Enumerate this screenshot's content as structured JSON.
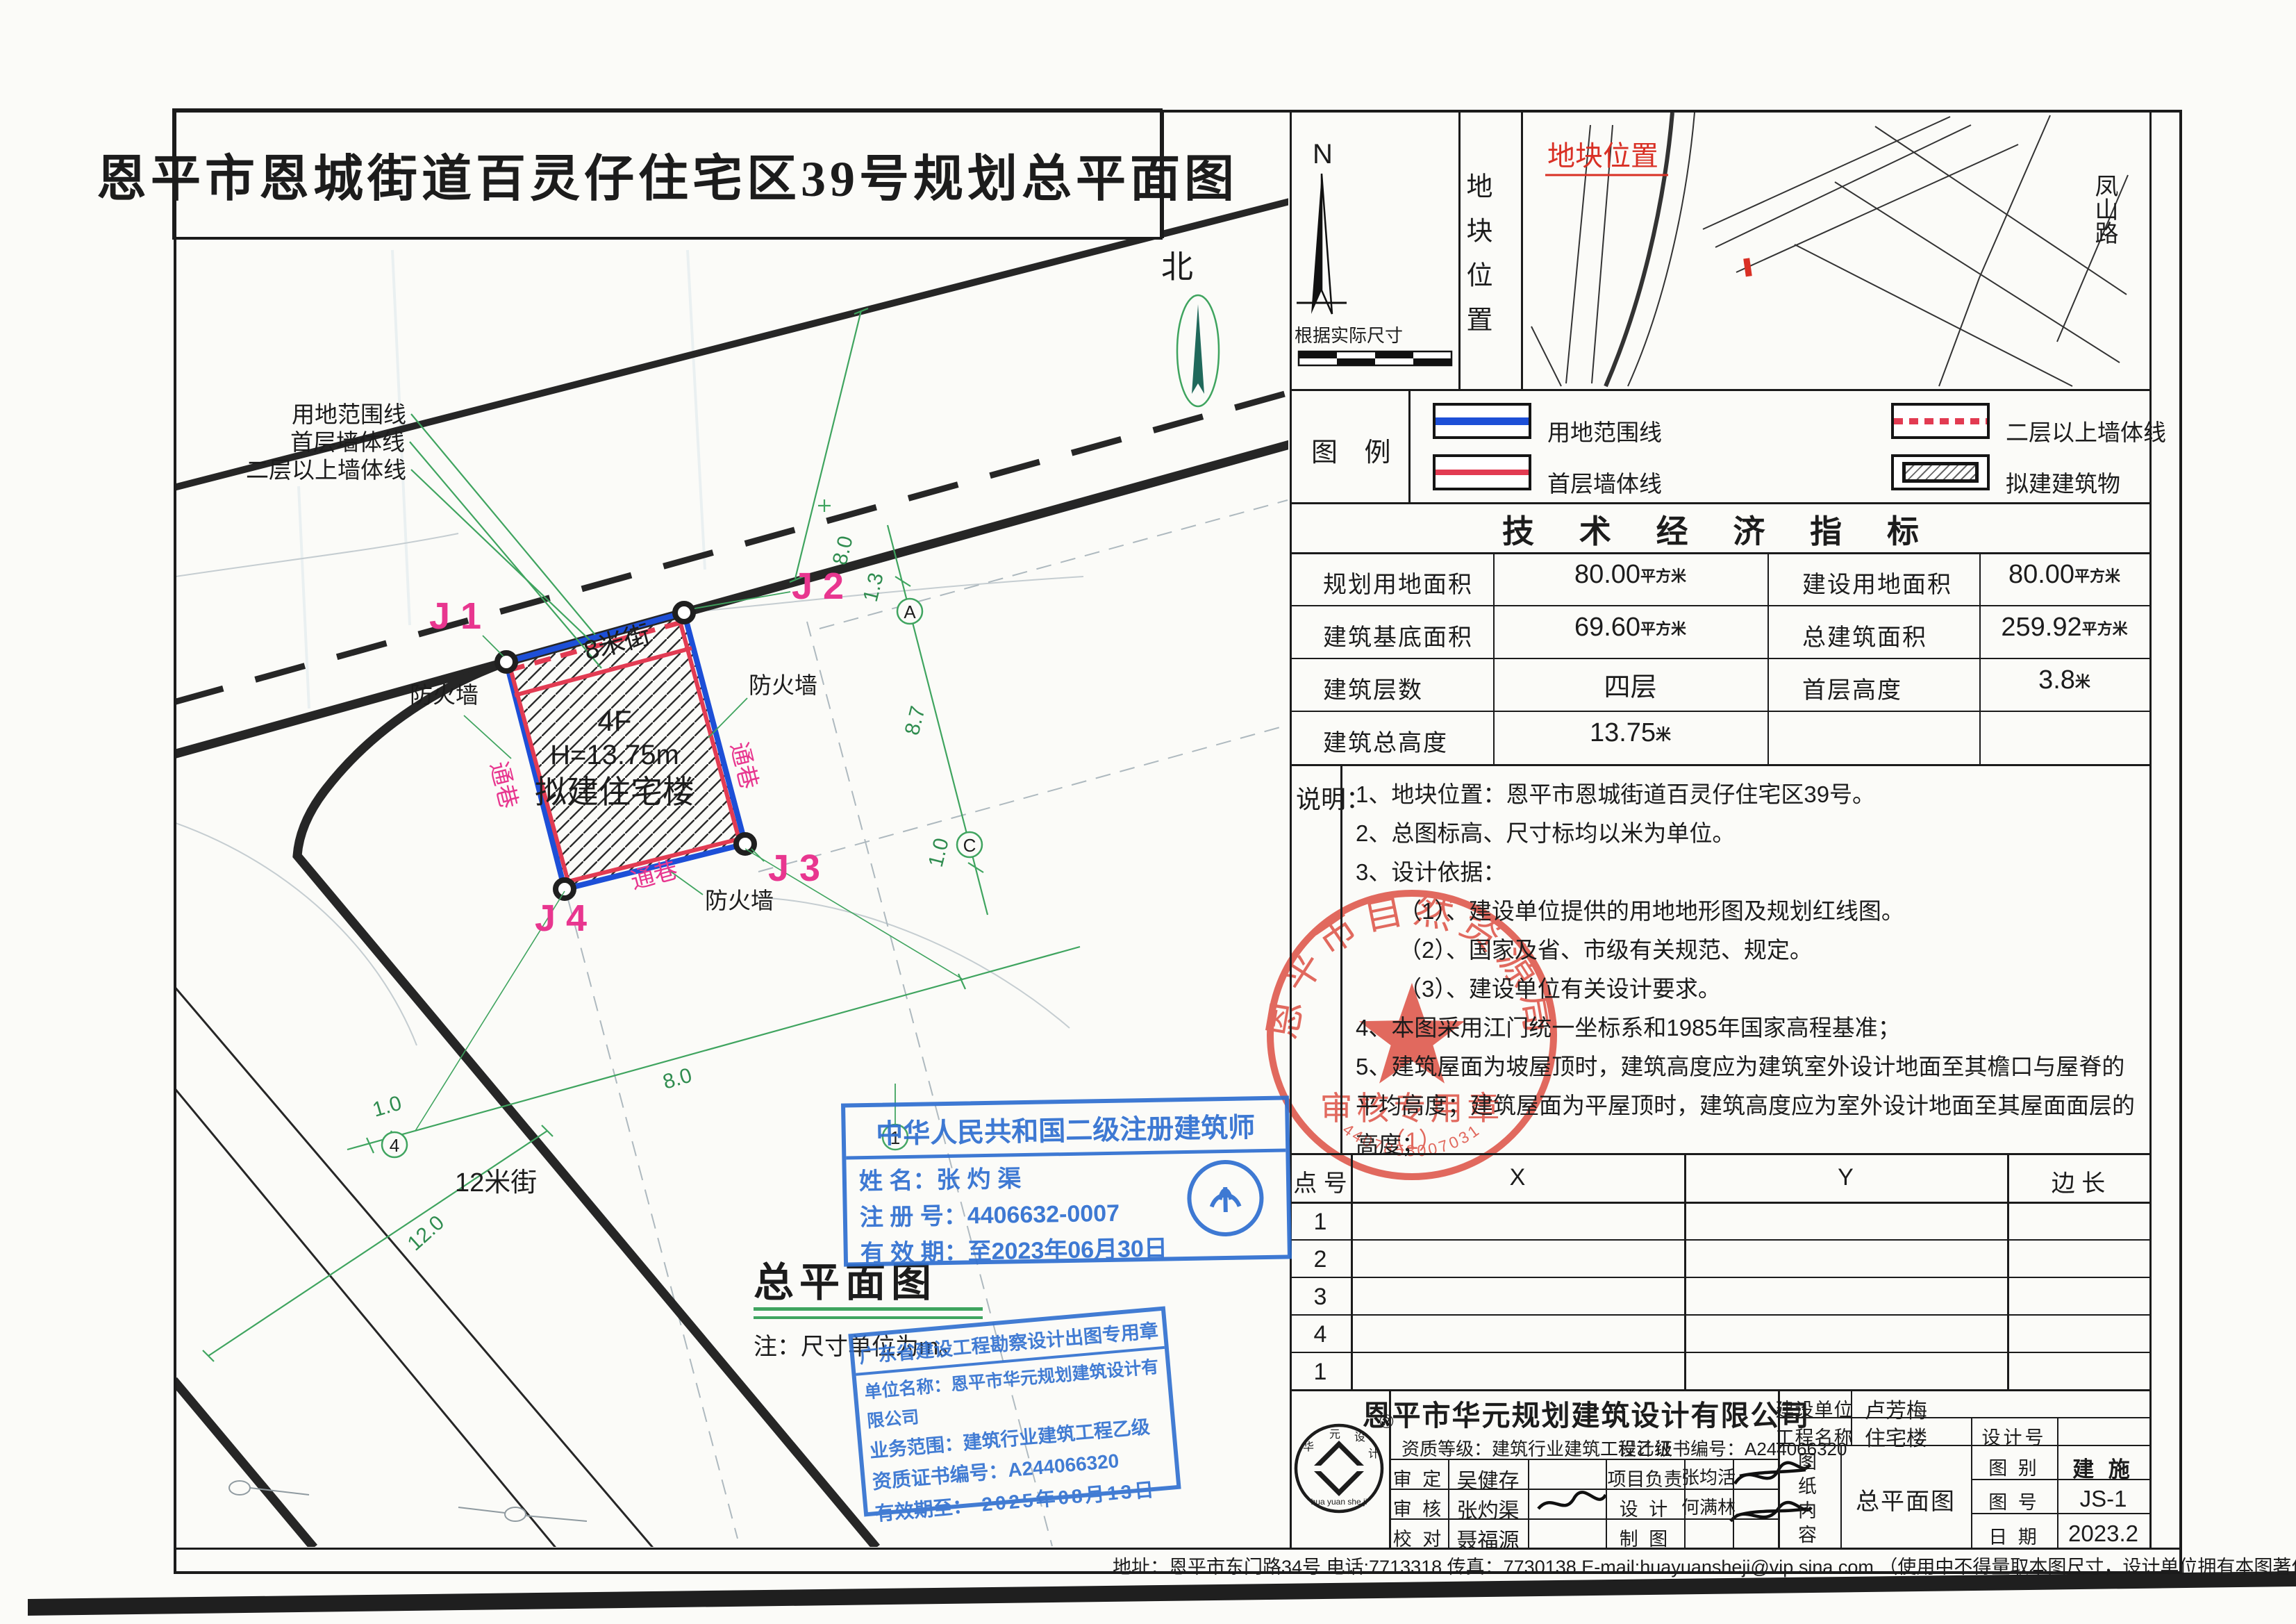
{
  "title": "恩平市恩城街道百灵仔住宅区39号规划总平面图",
  "colors": {
    "boundary_blue": "#1d4fd7",
    "wall_red": "#e23b52",
    "marker_magenta": "#e8368f",
    "dim_green": "#3fa45f",
    "stamp_blue": "#2e6fd0",
    "seal_red": "#dc4a3d"
  },
  "plan": {
    "north": "北",
    "streets": {
      "top": "8米街",
      "left": "12米街"
    },
    "building": {
      "floors": "4F",
      "height": "H=13.75m",
      "name": "拟建住宅楼"
    },
    "corners": {
      "j1": "J 1",
      "j2": "J 2",
      "j3": "J 3",
      "j4": "J 4"
    },
    "labels": {
      "boundary": "用地范围线",
      "first_floor_wall": "首层墙体线",
      "upper_wall": "二层以上墙体线",
      "firewall": "防火墙",
      "passage": "通巷"
    },
    "dims": {
      "road_top_width": "8.0",
      "d13": "1.3",
      "d87": "8.7",
      "d10_right": "1.0",
      "d10_bottom": "1.0",
      "d80_bottom": "8.0",
      "road_left_width": "12.0"
    },
    "axes": {
      "a": "A",
      "c": "C",
      "n4": "4",
      "n1": "1"
    },
    "subtitle": "总平面图",
    "subtitle_note": "注：尺寸单位为m。"
  },
  "panel": {
    "north_cell": {
      "n": "N",
      "note": "根据实际尺寸"
    },
    "location_cell": {
      "side_label": "地块位置",
      "map_title": "地块位置",
      "road": "凤山路"
    },
    "legend": {
      "title": "图 例",
      "items": [
        {
          "label": "用地范围线"
        },
        {
          "label": "二层以上墙体线"
        },
        {
          "label": "首层墙体线"
        },
        {
          "label": "拟建建筑物"
        }
      ]
    },
    "indicators": {
      "title": "技 术 经 济 指 标",
      "rows": [
        {
          "l1": "规划用地面积",
          "v1": "80.00",
          "u1": "平方米",
          "l2": "建设用地面积",
          "v2": "80.00",
          "u2": "平方米"
        },
        {
          "l1": "建筑基底面积",
          "v1": "69.60",
          "u1": "平方米",
          "l2": "总建筑面积",
          "v2": "259.92",
          "u2": "平方米"
        },
        {
          "l1": "建筑层数",
          "v1": "四层",
          "u1": "",
          "l2": "首层高度",
          "v2": "3.8",
          "u2": "米"
        },
        {
          "l1": "建筑总高度",
          "v1": "13.75",
          "u1": "米",
          "l2": "",
          "v2": "",
          "u2": ""
        }
      ]
    },
    "notes": {
      "label": "说明：",
      "lines": [
        "1、地块位置：恩平市恩城街道百灵仔住宅区39号。",
        "2、总图标高、尺寸标均以米为单位。",
        "3、设计依据：",
        "（1）、建设单位提供的用地地形图及规划红线图。",
        "（2）、国家及省、市级有关规范、规定。",
        "（3）、建设单位有关设计要求。",
        "4、本图采用江门统一坐标系和1985年国家高程基准；",
        "5、建筑屋面为坡屋顶时，建筑高度应为建筑室外设计地面至其檐口与屋脊的",
        "平均高度；建筑屋面为平屋顶时，建筑高度应为室外设计地面至其屋面面层的",
        "高度；"
      ]
    },
    "coords": {
      "point_header": "点 号",
      "x_header": "X",
      "y_header": "Y",
      "len_header": "边 长",
      "rows": [
        "1",
        "2",
        "3",
        "4",
        "1"
      ]
    },
    "titleblock": {
      "company": "恩平市华元规划建筑设计有限公司",
      "grade": "资质等级：建筑行业建筑工程乙级",
      "cert": "设计证书编号：A244066320",
      "client_label": "建设单位",
      "client": "卢芳梅",
      "project_label": "工程名称",
      "project": "住宅楼",
      "design_no_label": "设计号",
      "content_label": "图纸内容",
      "content": "总平面图",
      "cat_label": "图 别",
      "cat": "建 施",
      "no_label": "图 号",
      "no": "JS-1",
      "date_label": "日 期",
      "date": "2023.2",
      "roles": {
        "shending_label": "审 定",
        "shending": "吴健存",
        "shenhe_label": "审 核",
        "shenhe": "张灼渠",
        "jiaodui_label": "校 对",
        "jiaodui": "聂福源",
        "xiangmu_label": "项目负责",
        "xiangmu": "张均活",
        "sheji_label": "设  计",
        "sheji": "何满林",
        "zhitu_label": "制  图"
      },
      "logo_reg": "®",
      "logo_chars": {
        "c1": "华",
        "c2": "元",
        "c3": "设",
        "c4": "计"
      },
      "logo_latin": "hua yuan she ji"
    }
  },
  "stamps": {
    "architect": {
      "title": "中华人民共和国二级注册建筑师",
      "name_label": "姓    名：",
      "name": "张灼渠",
      "reg_label": "注 册 号：",
      "reg": "4406632-0007",
      "valid_label": "有 效 期：",
      "valid": "至2023年06月30日"
    },
    "gd": {
      "line1": "广东省建设工程勘察设计出图专用章",
      "line2": "单位名称：恩平市华元规划建筑设计有限公司",
      "line3": "业务范围：建筑行业建筑工程乙级",
      "line4": "资质证书编号：A244066320",
      "line5_label": "有效期至：",
      "line5": "2025年08月13日"
    },
    "seal": {
      "org": "恩平市自然资源局",
      "purpose": "审核专用章",
      "index": "（1）",
      "serial": "4407853007031"
    }
  },
  "footer": "地址：恩平市东门路34号  电话:7713318  传真：7730138  E-mail:huayuansheji@vip.sina.com  （使用中不得量取本图尺寸，设计单位拥有本图著作权，本图没有盖章无效）"
}
